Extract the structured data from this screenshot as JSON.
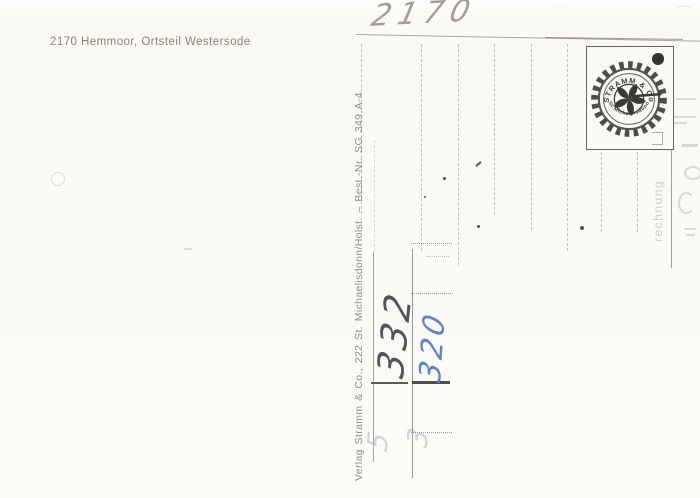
{
  "postcard": {
    "caption": "2170 Hemmoor, Ortsteil Westersode",
    "publisher_imprint": "Verlag Stramm & Co., 222 St. Michaelisdonn/Holst. – Best.-Nr. SG 349 A-4",
    "stamp": {
      "arc_top": "STRAMM & Co",
      "arc_bottom": "St.Michaelisdonn"
    },
    "handwriting": {
      "top_number": "2170",
      "number_dark": "332",
      "number_blue": "320",
      "faint_number_left": "5",
      "faint_number_right": "3"
    },
    "bleedthrough_vertical_text": "rechnung",
    "colors": {
      "paper": "#fbfaf5",
      "caption_text": "#8b8377",
      "imprint_text": "#8f8e89",
      "pencil": "#a29e96",
      "ink_dark": "#54545c",
      "ink_blue": "#5f83c6",
      "stamp_ink": "#3c3a35",
      "form_line": "#8d897e"
    }
  }
}
